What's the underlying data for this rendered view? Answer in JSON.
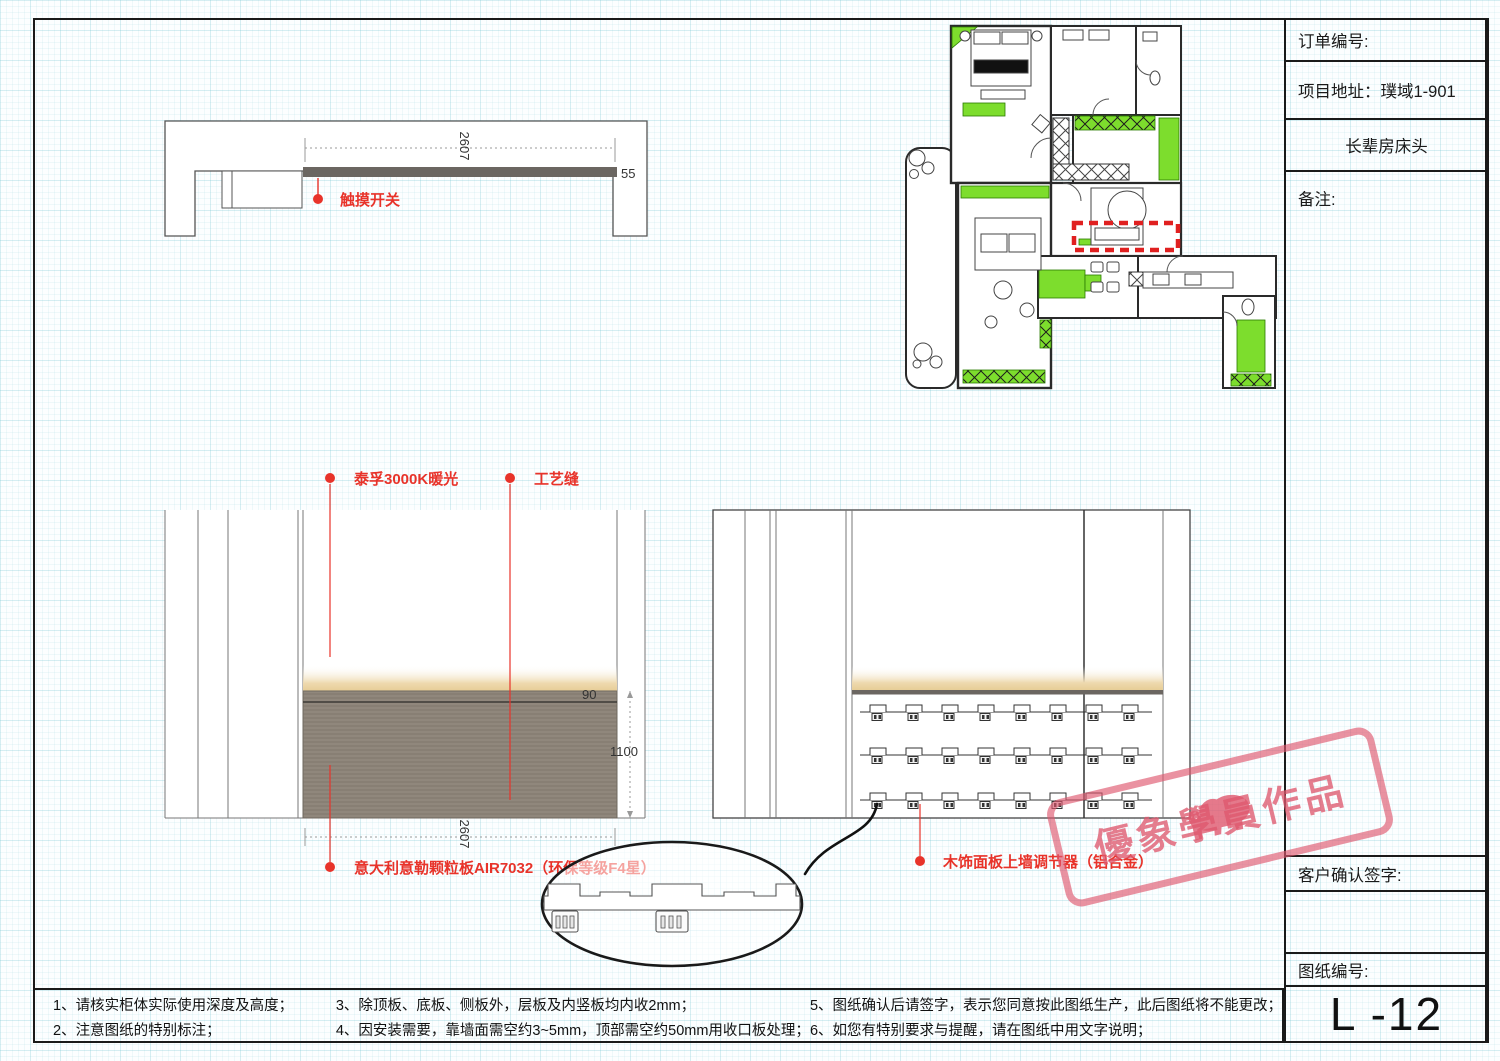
{
  "colors": {
    "accent_red": "#e8332a",
    "highlight_green": "#7ddd2d",
    "panel_gray": "#8d8478",
    "glow_cream": "#ecd6a4",
    "strip_dark": "#6b6661",
    "stamp_pink": "#de586e",
    "plan_highlight_red": "#e02020"
  },
  "title_block": {
    "order_no_label": "订单编号:",
    "address_label": "项目地址：",
    "address_value": "璞域1-901",
    "drawing_title": "长辈房床头",
    "remark_label": "备注:",
    "sign_label": "客户确认签字:",
    "sheet_no_label": "图纸编号:",
    "sheet_no": "L -12"
  },
  "annotations": {
    "touch_switch": "触摸开关",
    "warm_light": "泰孚3000K暖光",
    "craft_seam": "工艺缝",
    "panel_material": "意大利意勒颗粒板AIR7032（环保等级F4星）",
    "wall_adjuster": "木饰面板上墙调节器（铝合金）"
  },
  "dimensions": {
    "top_width": "2607",
    "top_thickness": "55",
    "strip_height": "90",
    "panel_height": "1100",
    "panel_width": "2607"
  },
  "notes": [
    "1、请核实柜体实际使用深度及高度；",
    "2、注意图纸的特别标注；",
    "3、除顶板、底板、侧板外，层板及内竖板均内收2mm；",
    "4、因安装需要，靠墙面需空约3~5mm，顶部需空约50mm用收口板处理；",
    "5、图纸确认后请签字，表示您同意按此图纸生产，此后图纸将不能更改；",
    "6、如您有特别要求与提醒，请在图纸中用文字说明；"
  ],
  "watermark": {
    "text": "優象學員作品"
  }
}
